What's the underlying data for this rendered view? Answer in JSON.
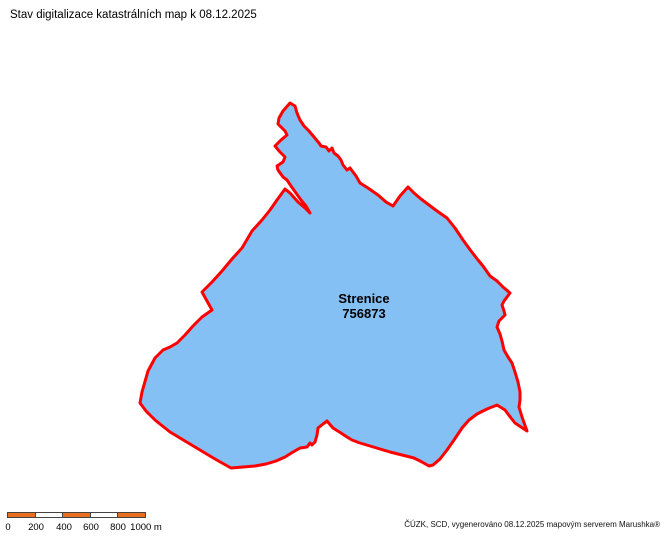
{
  "title": "Stav digitalizace katastrálních map k 08.12.2025",
  "map": {
    "label": {
      "name": "Strenice",
      "code": "756873"
    },
    "polygon": {
      "fill": "#85C0F4",
      "stroke": "#FF0000",
      "stroke_width": 3,
      "points": [
        [
          290,
          103
        ],
        [
          295,
          106
        ],
        [
          297,
          113
        ],
        [
          300,
          120
        ],
        [
          304,
          126
        ],
        [
          309,
          131
        ],
        [
          314,
          137
        ],
        [
          319,
          143
        ],
        [
          321,
          146
        ],
        [
          326,
          147
        ],
        [
          329,
          151
        ],
        [
          332,
          148
        ],
        [
          334,
          153
        ],
        [
          338,
          156
        ],
        [
          341,
          160
        ],
        [
          343,
          165
        ],
        [
          347,
          170
        ],
        [
          350,
          168
        ],
        [
          353,
          172
        ],
        [
          356,
          176
        ],
        [
          360,
          183
        ],
        [
          368,
          188
        ],
        [
          378,
          195
        ],
        [
          386,
          202
        ],
        [
          393,
          206
        ],
        [
          400,
          196
        ],
        [
          408,
          187
        ],
        [
          414,
          193
        ],
        [
          421,
          199
        ],
        [
          429,
          205
        ],
        [
          437,
          211
        ],
        [
          447,
          218
        ],
        [
          455,
          228
        ],
        [
          463,
          240
        ],
        [
          471,
          251
        ],
        [
          478,
          260
        ],
        [
          483,
          266
        ],
        [
          490,
          276
        ],
        [
          497,
          281
        ],
        [
          503,
          287
        ],
        [
          510,
          293
        ],
        [
          504,
          301
        ],
        [
          502,
          305
        ],
        [
          504,
          311
        ],
        [
          505,
          315
        ],
        [
          499,
          321
        ],
        [
          497,
          327
        ],
        [
          500,
          334
        ],
        [
          502,
          341
        ],
        [
          504,
          350
        ],
        [
          508,
          357
        ],
        [
          512,
          363
        ],
        [
          515,
          372
        ],
        [
          518,
          382
        ],
        [
          520,
          392
        ],
        [
          520,
          400
        ],
        [
          519,
          407
        ],
        [
          522,
          417
        ],
        [
          527,
          431
        ],
        [
          515,
          423
        ],
        [
          511,
          418
        ],
        [
          505,
          410
        ],
        [
          497,
          405
        ],
        [
          487,
          409
        ],
        [
          477,
          414
        ],
        [
          469,
          420
        ],
        [
          462,
          428
        ],
        [
          454,
          440
        ],
        [
          447,
          450
        ],
        [
          440,
          459
        ],
        [
          433,
          465
        ],
        [
          429,
          466
        ],
        [
          422,
          462
        ],
        [
          414,
          458
        ],
        [
          406,
          456
        ],
        [
          398,
          454
        ],
        [
          390,
          452
        ],
        [
          380,
          449
        ],
        [
          370,
          446
        ],
        [
          360,
          443
        ],
        [
          352,
          440
        ],
        [
          347,
          437
        ],
        [
          341,
          433
        ],
        [
          333,
          428
        ],
        [
          327,
          421
        ],
        [
          323,
          424
        ],
        [
          318,
          428
        ],
        [
          317,
          435
        ],
        [
          315,
          442
        ],
        [
          312,
          445
        ],
        [
          310,
          443
        ],
        [
          307,
          447
        ],
        [
          300,
          448
        ],
        [
          293,
          452
        ],
        [
          285,
          457
        ],
        [
          276,
          461
        ],
        [
          266,
          464
        ],
        [
          255,
          466
        ],
        [
          243,
          467
        ],
        [
          231,
          468
        ],
        [
          215,
          459
        ],
        [
          200,
          450
        ],
        [
          185,
          441
        ],
        [
          170,
          432
        ],
        [
          155,
          420
        ],
        [
          146,
          411
        ],
        [
          140,
          403
        ],
        [
          142,
          392
        ],
        [
          146,
          378
        ],
        [
          148,
          371
        ],
        [
          155,
          358
        ],
        [
          163,
          350
        ],
        [
          170,
          347
        ],
        [
          177,
          343
        ],
        [
          185,
          335
        ],
        [
          193,
          326
        ],
        [
          202,
          317
        ],
        [
          212,
          310
        ],
        [
          202,
          292
        ],
        [
          212,
          282
        ],
        [
          222,
          271
        ],
        [
          232,
          259
        ],
        [
          242,
          248
        ],
        [
          252,
          231
        ],
        [
          262,
          220
        ],
        [
          270,
          210
        ],
        [
          277,
          200
        ],
        [
          285,
          189
        ],
        [
          290,
          193
        ],
        [
          298,
          202
        ],
        [
          305,
          208
        ],
        [
          310,
          213
        ],
        [
          306,
          206
        ],
        [
          301,
          200
        ],
        [
          296,
          193
        ],
        [
          291,
          186
        ],
        [
          287,
          180
        ],
        [
          283,
          177
        ],
        [
          278,
          170
        ],
        [
          277,
          166
        ],
        [
          283,
          162
        ],
        [
          285,
          157
        ],
        [
          280,
          152
        ],
        [
          275,
          146
        ],
        [
          281,
          140
        ],
        [
          287,
          135
        ],
        [
          285,
          131
        ],
        [
          278,
          124
        ],
        [
          279,
          118
        ],
        [
          283,
          111
        ]
      ]
    }
  },
  "scalebar": {
    "segment_colors": [
      "#E56F1E",
      "#FFFFFF",
      "#E56F1E",
      "#FFFFFF",
      "#E56F1E"
    ],
    "labels": [
      {
        "text": "0",
        "x": 1
      },
      {
        "text": "200",
        "x": 29
      },
      {
        "text": "400",
        "x": 57
      },
      {
        "text": "600",
        "x": 84
      },
      {
        "text": "800",
        "x": 111
      },
      {
        "text": "1000 m",
        "x": 139
      }
    ]
  },
  "attribution": "ČÚZK, SCD, vygenerováno 08.12.2025 mapovým serverem Marushka®"
}
